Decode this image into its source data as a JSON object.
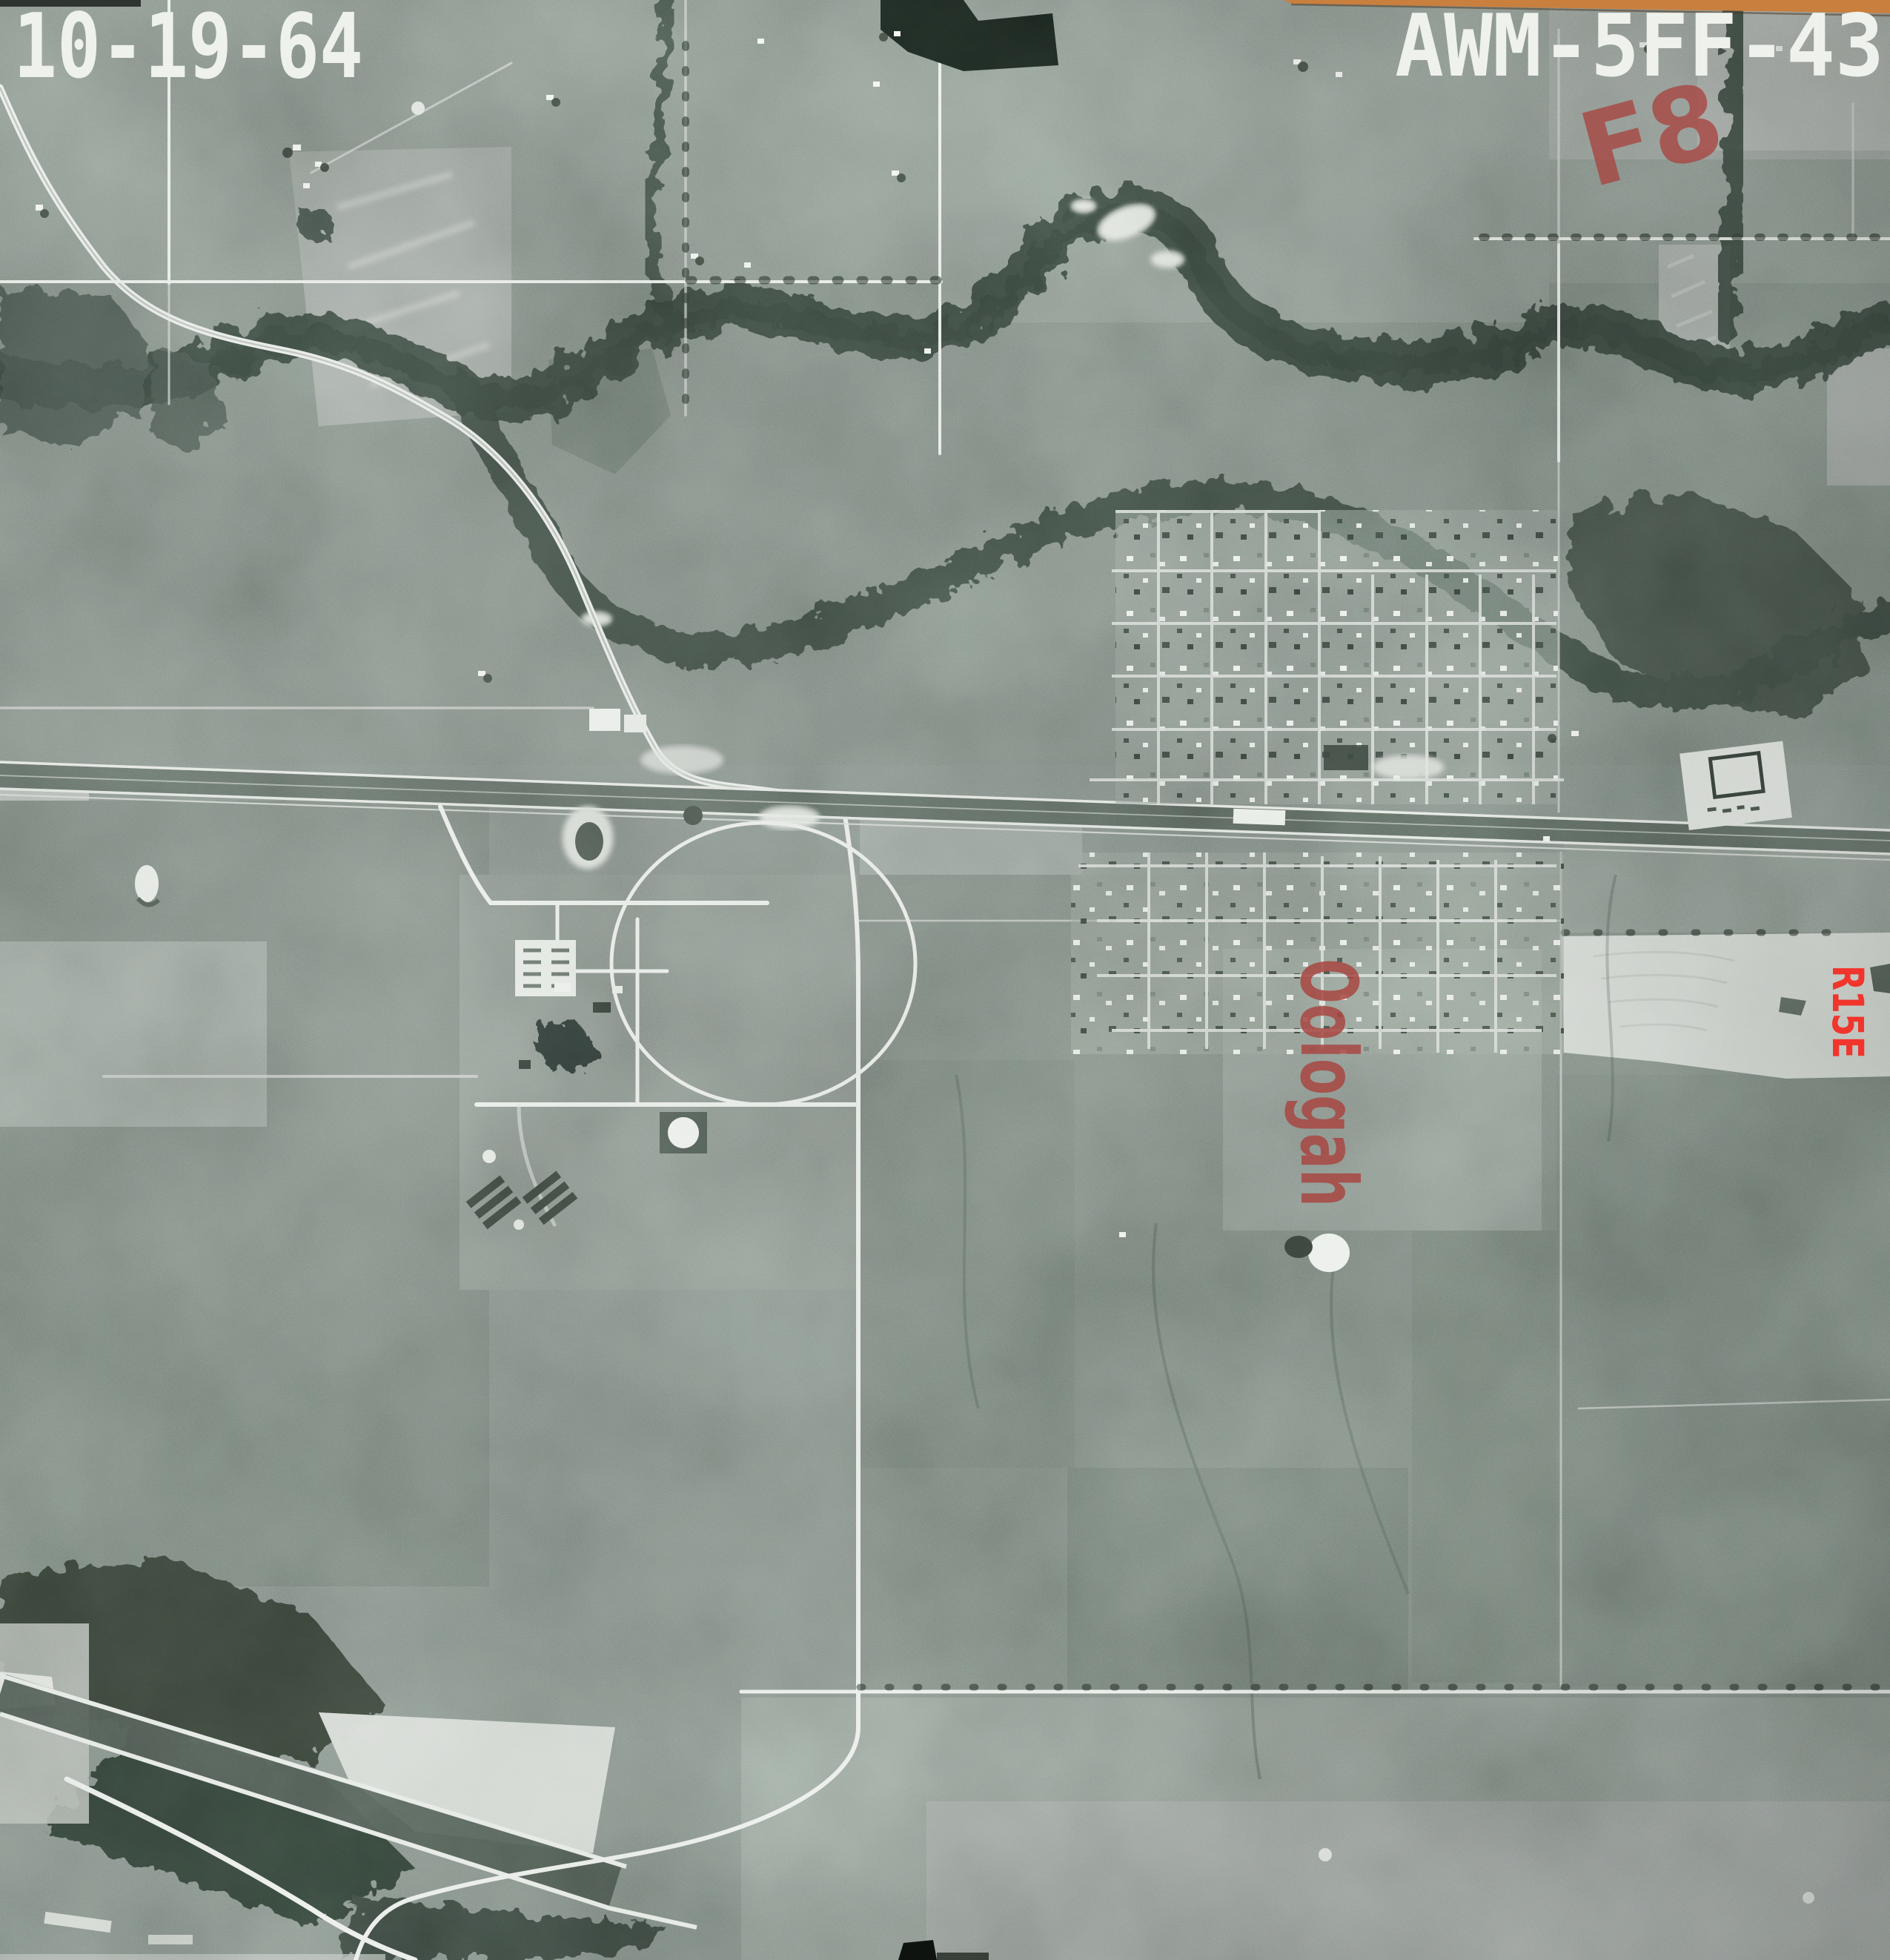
{
  "photo": {
    "date_stamp": "10-19-64",
    "photo_id": "AWM-5FF-43",
    "annotations": {
      "exposure_note": "F8",
      "town_label": "Oologah",
      "range_label": "R15E"
    },
    "colors": {
      "stamp_white": "#eef1ec",
      "marker_red": "#a84742",
      "marker_red_bright": "#f1352c",
      "film_edge_orange": "#c97f3e"
    }
  }
}
